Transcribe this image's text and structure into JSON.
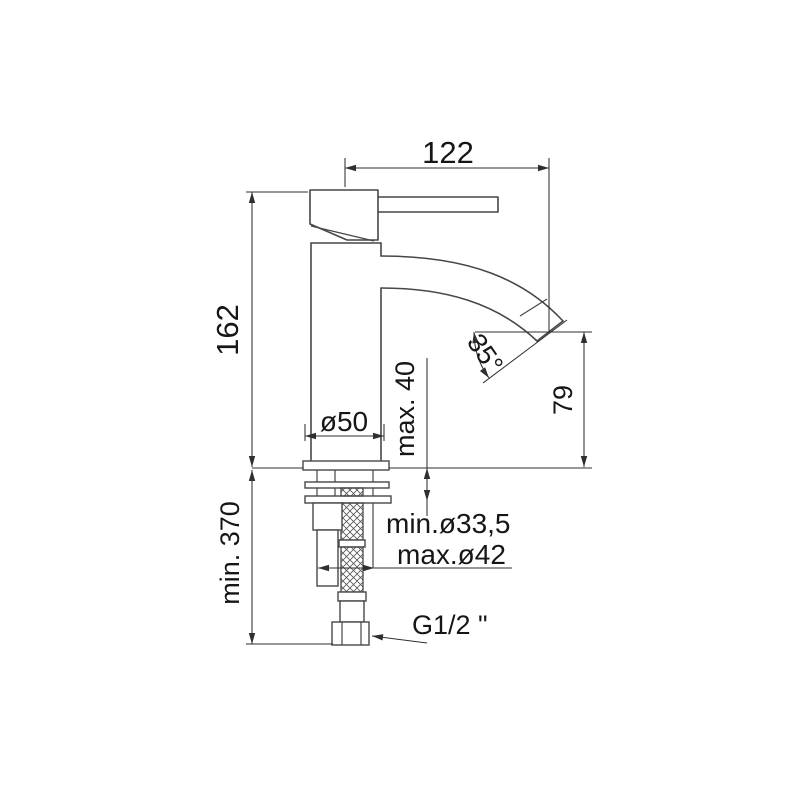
{
  "drawing": {
    "type": "technical-dimension-drawing",
    "subject": "single-lever basin mixer tap, side view with installation dimensions (mm)",
    "line_color": "#474747",
    "background_color": "#ffffff",
    "dimensions": {
      "spout_reach": "122",
      "body_height": "162",
      "spout_angle": "35°",
      "outlet_height": "79",
      "base_diameter": "ø50",
      "max_deck_thickness": "max. 40",
      "min_hole_diameter": "min.ø33,5",
      "max_hole_diameter": "max.ø42",
      "min_clearance_below": "min. 370",
      "connection_thread": "G1/2 \""
    }
  }
}
